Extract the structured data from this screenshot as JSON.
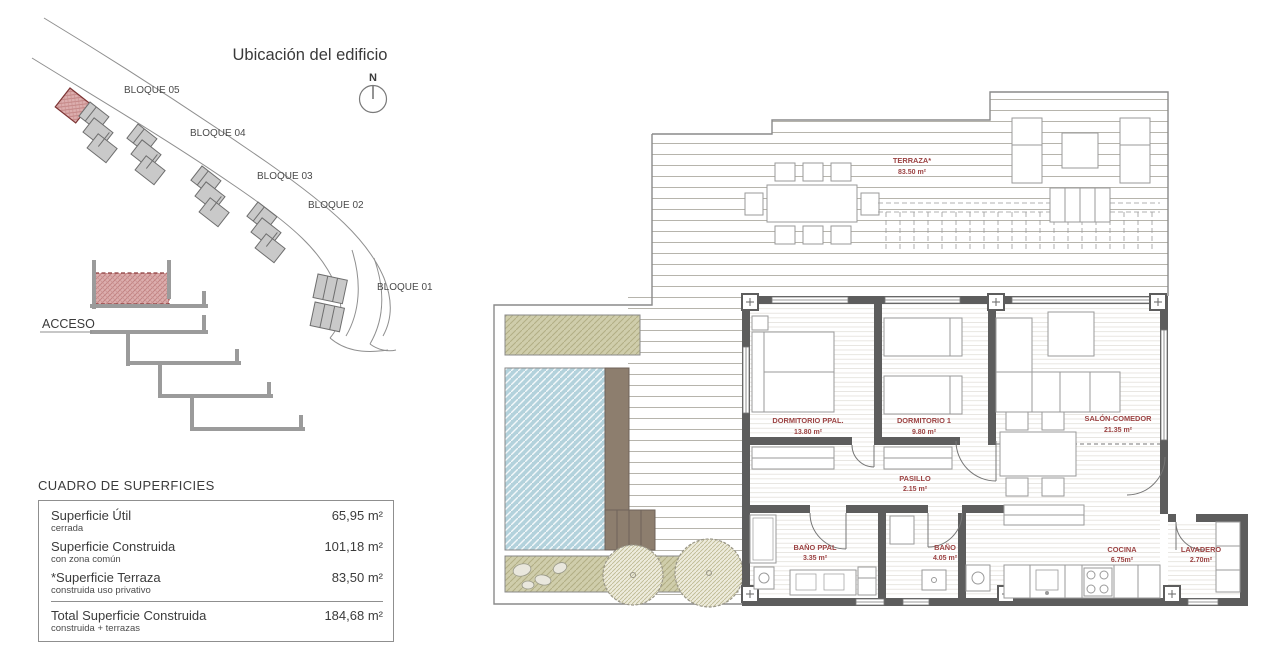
{
  "site_plan": {
    "title": "Ubicación del edificio",
    "compass": "N",
    "access_label": "ACCESO",
    "block_labels": [
      "BLOQUE 05",
      "BLOQUE 04",
      "BLOQUE 03",
      "BLOQUE 02",
      "BLOQUE 01"
    ]
  },
  "surface_table": {
    "title": "CUADRO DE SUPERFICIES",
    "rows": [
      {
        "label": "Superficie Útil",
        "note": "cerrada",
        "value": "65,95 m²"
      },
      {
        "label": "Superficie Construida",
        "note": "con zona común",
        "value": "101,18 m²"
      },
      {
        "label": "*Superficie Terraza",
        "note": "construida uso privativo",
        "value": "83,50 m²"
      }
    ],
    "total": {
      "label": "Total Superficie Construida",
      "note": "construida + terrazas",
      "value": "184,68 m²"
    }
  },
  "floor_plan": {
    "rooms": [
      {
        "name": "TERRAZA*",
        "area": "83.50 m²"
      },
      {
        "name": "DORMITORIO PPAL.",
        "area": "13.80 m²"
      },
      {
        "name": "DORMITORIO 1",
        "area": "9.80 m²"
      },
      {
        "name": "SALÓN-COMEDOR",
        "area": "21.35 m²"
      },
      {
        "name": "PASILLO",
        "area": "2.15 m²"
      },
      {
        "name": "BAÑO PPAL",
        "area": "3.35 m²"
      },
      {
        "name": "BAÑO",
        "area": "4.05 m²"
      },
      {
        "name": "COCINA",
        "area": "6.75m²"
      },
      {
        "name": "LAVADERO",
        "area": "2.70m²"
      }
    ]
  },
  "colors": {
    "label_red": "#9c4343",
    "highlight_red_fill": "#dcaeae",
    "wall_gray": "#5d5d5d",
    "pool_blue": "#b3d2dc",
    "planter_khaki": "#cfcdab",
    "deck_brown": "#8d7e6e"
  }
}
